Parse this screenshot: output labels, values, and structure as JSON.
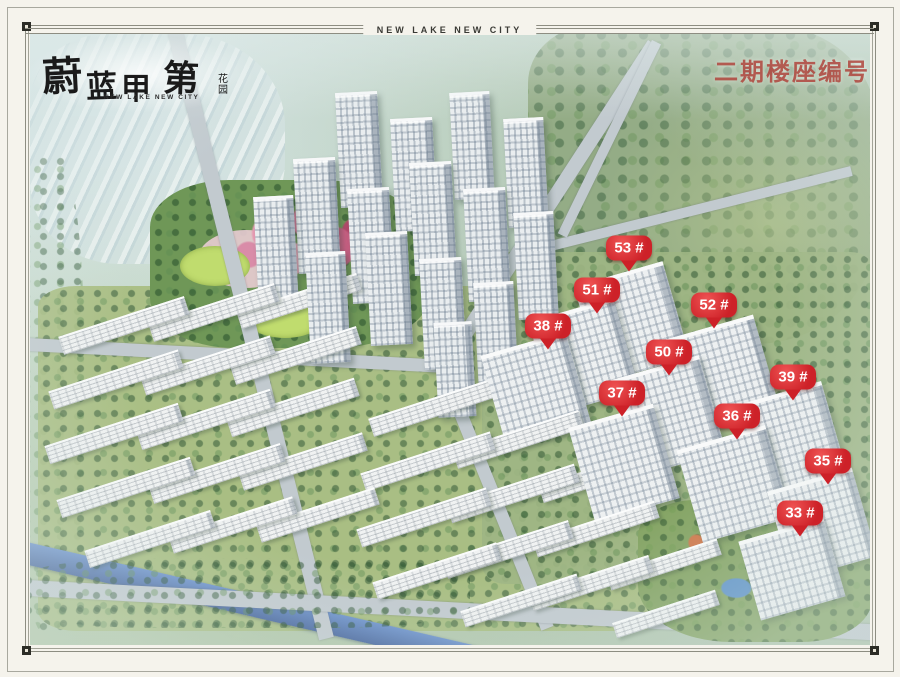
{
  "frame": {
    "title_band": "NEW LAKE NEW CITY"
  },
  "logo": {
    "calligraphy": "蔚蓝甲第",
    "suffix": "花园",
    "subtitle": "NEW LAKE NEW CITY"
  },
  "legend": {
    "title": "二期楼座编号"
  },
  "badges": [
    {
      "label": "53 #",
      "x": 629,
      "y": 248
    },
    {
      "label": "51 #",
      "x": 597,
      "y": 290
    },
    {
      "label": "52 #",
      "x": 714,
      "y": 305
    },
    {
      "label": "38 #",
      "x": 548,
      "y": 326
    },
    {
      "label": "50 #",
      "x": 669,
      "y": 352
    },
    {
      "label": "37 #",
      "x": 622,
      "y": 393
    },
    {
      "label": "39 #",
      "x": 793,
      "y": 377
    },
    {
      "label": "36 #",
      "x": 737,
      "y": 416
    },
    {
      "label": "35 #",
      "x": 828,
      "y": 461
    },
    {
      "label": "33 #",
      "x": 800,
      "y": 513
    }
  ],
  "colors": {
    "badge_red": "#cd2128",
    "legend_red": "#b2423b",
    "canal_blue": "#5b7fbe",
    "logo_ink": "#1a1a1a"
  }
}
